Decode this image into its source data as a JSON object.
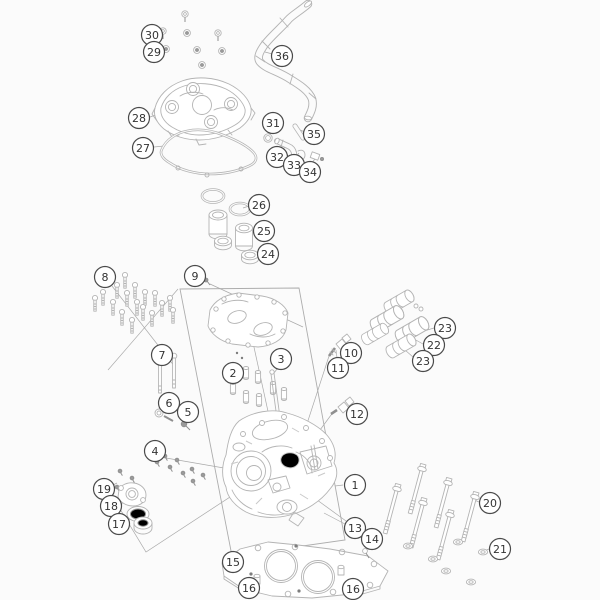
{
  "diagram": {
    "type": "exploded-parts-diagram",
    "subject": "cylinder head assembly",
    "background_color": "#fbfbfb",
    "artwork_color": "#b4b4b4",
    "callout_ring_color": "#4a4a4a",
    "callout_text_color": "#333333",
    "callouts": [
      {
        "label": "30",
        "x": 152,
        "y": 35
      },
      {
        "label": "29",
        "x": 154,
        "y": 52
      },
      {
        "label": "36",
        "x": 282,
        "y": 56
      },
      {
        "label": "28",
        "x": 139,
        "y": 118
      },
      {
        "label": "27",
        "x": 143,
        "y": 148
      },
      {
        "label": "31",
        "x": 273,
        "y": 123
      },
      {
        "label": "35",
        "x": 314,
        "y": 134
      },
      {
        "label": "32",
        "x": 277,
        "y": 157
      },
      {
        "label": "33",
        "x": 294,
        "y": 165
      },
      {
        "label": "34",
        "x": 310,
        "y": 172
      },
      {
        "label": "26",
        "x": 259,
        "y": 205
      },
      {
        "label": "25",
        "x": 264,
        "y": 231
      },
      {
        "label": "24",
        "x": 268,
        "y": 254
      },
      {
        "label": "8",
        "x": 105,
        "y": 277
      },
      {
        "label": "9",
        "x": 195,
        "y": 276
      },
      {
        "label": "23",
        "x": 445,
        "y": 328
      },
      {
        "label": "22",
        "x": 434,
        "y": 345
      },
      {
        "label": "23",
        "x": 423,
        "y": 361
      },
      {
        "label": "7",
        "x": 162,
        "y": 355
      },
      {
        "label": "3",
        "x": 281,
        "y": 359
      },
      {
        "label": "10",
        "x": 351,
        "y": 353
      },
      {
        "label": "11",
        "x": 338,
        "y": 368
      },
      {
        "label": "2",
        "x": 233,
        "y": 373
      },
      {
        "label": "6",
        "x": 169,
        "y": 403
      },
      {
        "label": "5",
        "x": 188,
        "y": 412
      },
      {
        "label": "12",
        "x": 357,
        "y": 414
      },
      {
        "label": "4",
        "x": 155,
        "y": 451
      },
      {
        "label": "1",
        "x": 355,
        "y": 485
      },
      {
        "label": "19",
        "x": 104,
        "y": 489
      },
      {
        "label": "18",
        "x": 111,
        "y": 506
      },
      {
        "label": "17",
        "x": 119,
        "y": 524
      },
      {
        "label": "20",
        "x": 490,
        "y": 503
      },
      {
        "label": "13",
        "x": 355,
        "y": 528
      },
      {
        "label": "14",
        "x": 372,
        "y": 539
      },
      {
        "label": "21",
        "x": 500,
        "y": 549
      },
      {
        "label": "15",
        "x": 233,
        "y": 562
      },
      {
        "label": "16",
        "x": 249,
        "y": 588
      },
      {
        "label": "16",
        "x": 353,
        "y": 589
      }
    ]
  }
}
